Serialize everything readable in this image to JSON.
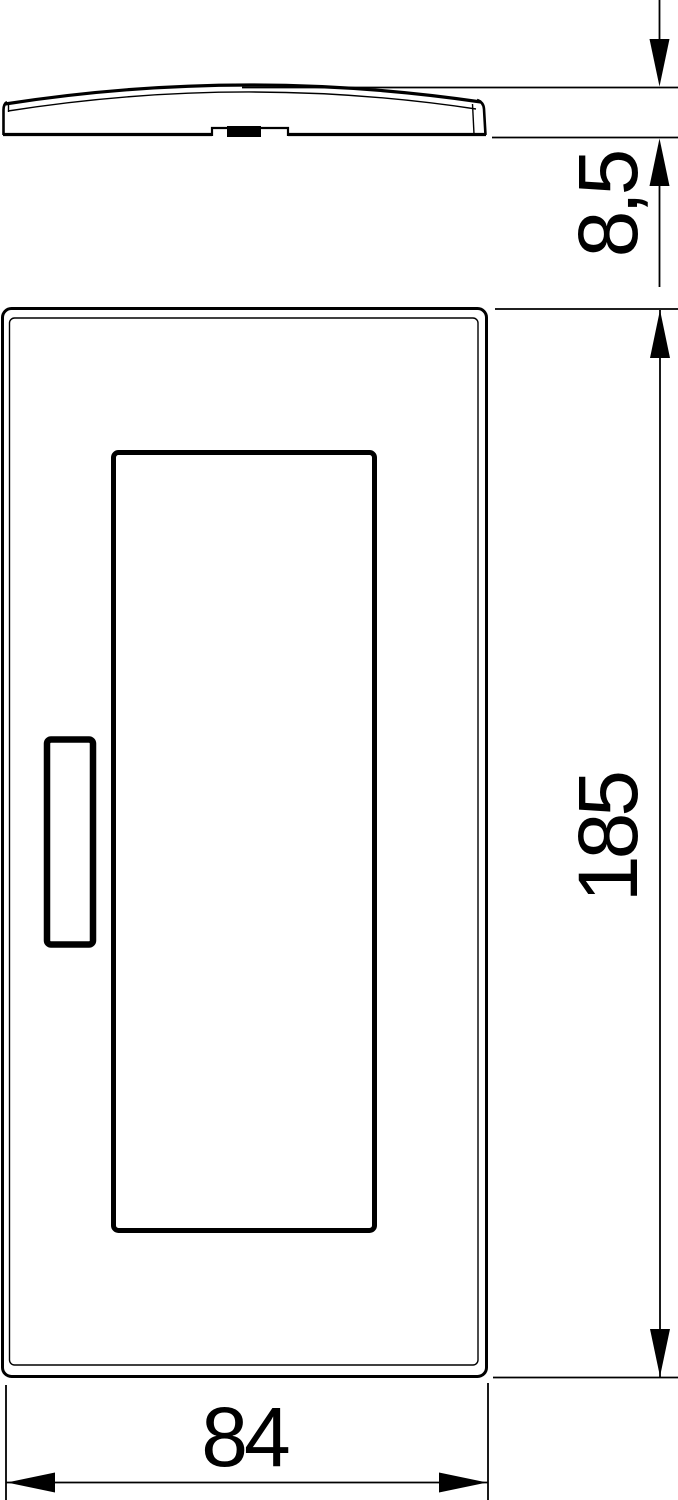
{
  "page": {
    "background": "#ffffff",
    "line_color": "#000000",
    "description": "Technical dimension drawing of a cover plate: side profile view (top) and front view (bottom)"
  },
  "dimensions": {
    "thickness": {
      "label": "8,5"
    },
    "length": {
      "label": "185"
    },
    "width": {
      "label": "84"
    }
  }
}
